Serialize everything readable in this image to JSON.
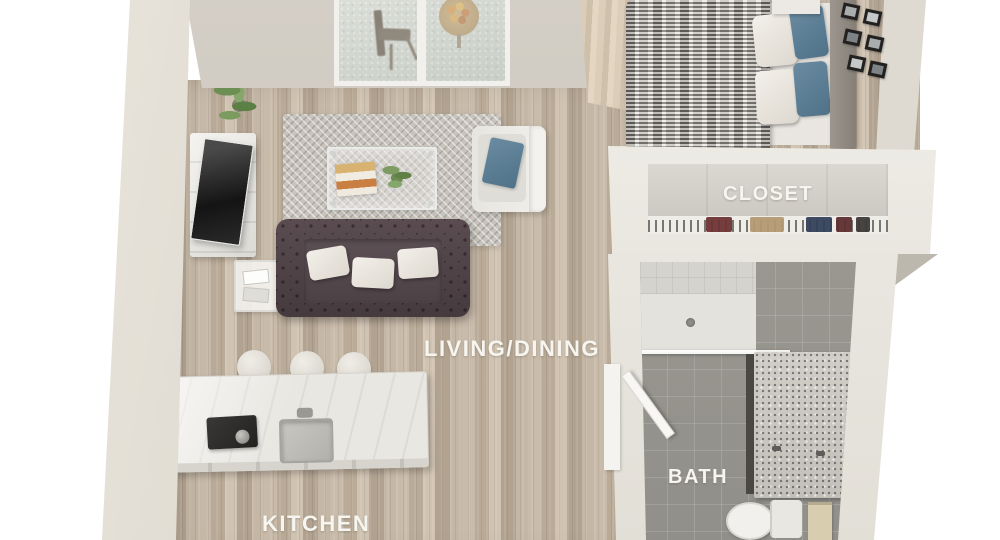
{
  "view": {
    "type": "3d-floor-plan-rendering",
    "background": "#ffffff"
  },
  "rooms": {
    "living_dining": {
      "label": "LIVING/DINING",
      "furniture": [
        "sofa",
        "white-throw-pillows",
        "coffee-table",
        "books-tray",
        "table-plant",
        "area-rug",
        "armchair",
        "blue-accent-pillow",
        "tv-console",
        "tv",
        "potted-plant",
        "side-table",
        "balcony-window"
      ]
    },
    "kitchen": {
      "label": "KITCHEN",
      "furniture": [
        "island-counter",
        "cooktop",
        "kettle",
        "sink",
        "faucet",
        "bar-stools"
      ]
    },
    "bedroom": {
      "furniture": [
        "bed",
        "knit-blanket",
        "white-pillows",
        "blue-pillows",
        "headboard",
        "nightstand",
        "picture-frames",
        "curtain"
      ]
    },
    "closet": {
      "label": "CLOSET",
      "furniture": [
        "clothes-rail",
        "hanging-clothes"
      ]
    },
    "bath": {
      "label": "BATH",
      "furniture": [
        "shower",
        "glass-partition",
        "vanity",
        "double-faucets",
        "toilet",
        "towel-rack"
      ]
    },
    "balcony": {
      "furniture": [
        "bistro-chair",
        "fruit-bowl-table"
      ]
    }
  },
  "palette": {
    "floor_wood": "#c2b3a1",
    "floor_tile": "#918f8a",
    "rug": "#c8c4bd",
    "sofa": "#453a3e",
    "pillow_white": "#ddd8cf",
    "pillow_blue": "#4f7288",
    "counter": "#e9e7e2",
    "appliance_dark": "#242220",
    "wall": "#d5d0c6",
    "wall_light": "#efece6",
    "label_text": "#f7f5f0"
  }
}
